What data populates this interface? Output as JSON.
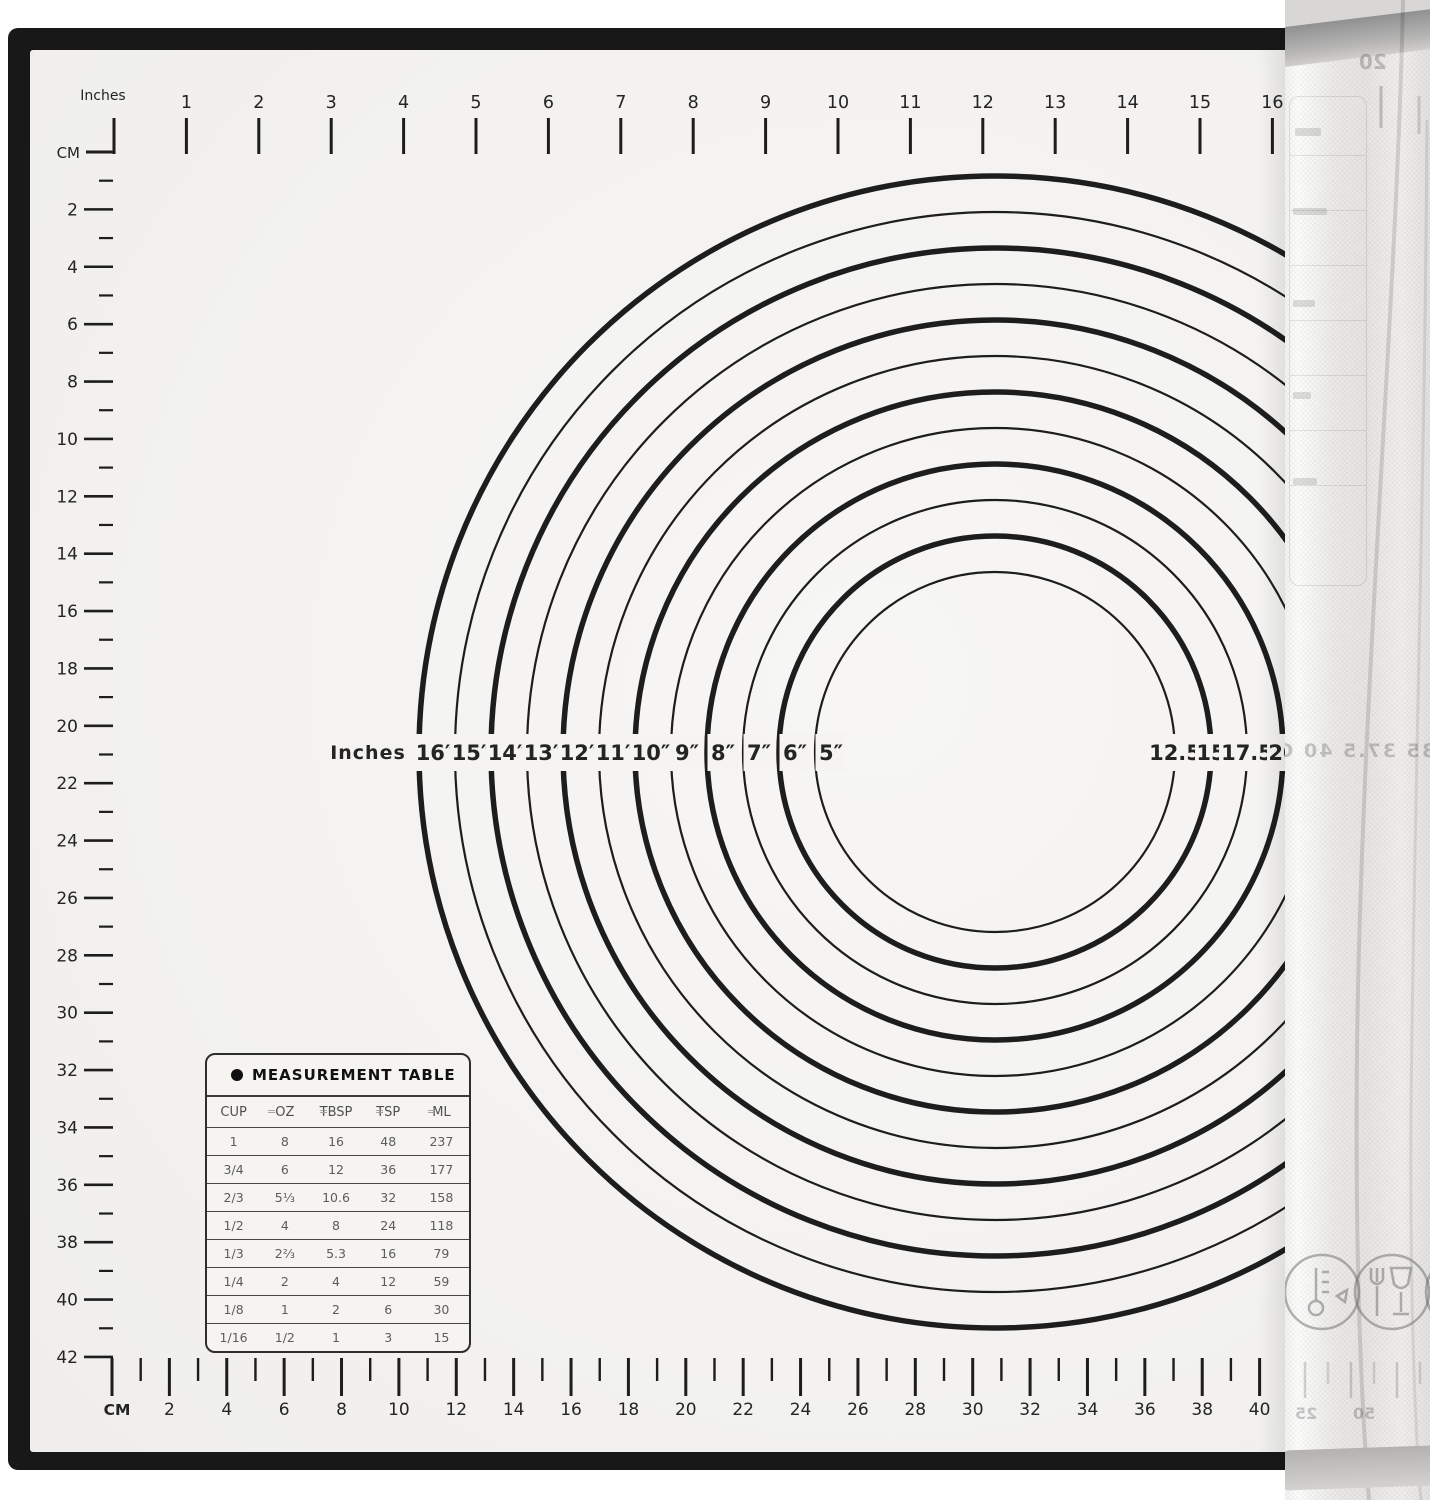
{
  "colors": {
    "frame": "#181818",
    "mat_surface": "#f5f4f1",
    "ink": "#1d1d1d",
    "table_value_text": "#5c5c5c",
    "roll_base": "#ebeae8"
  },
  "top_ruler": {
    "unit_label": "Inches",
    "labels": [
      "1",
      "2",
      "3",
      "4",
      "5",
      "6",
      "7",
      "8",
      "9",
      "10",
      "11",
      "12",
      "13",
      "14",
      "15",
      "16"
    ]
  },
  "left_ruler": {
    "unit_label": "CM",
    "labels": [
      "2",
      "4",
      "6",
      "8",
      "10",
      "12",
      "14",
      "16",
      "18",
      "20",
      "22",
      "24",
      "26",
      "28",
      "30",
      "32",
      "34",
      "36",
      "38",
      "40",
      "42"
    ]
  },
  "bottom_ruler": {
    "unit_label": "CM",
    "labels": [
      "2",
      "4",
      "6",
      "8",
      "10",
      "12",
      "14",
      "16",
      "18",
      "20",
      "22",
      "24",
      "26",
      "28",
      "30",
      "32",
      "34",
      "36",
      "38",
      "40"
    ]
  },
  "circles": {
    "row_unit_label": "Inches",
    "rings": [
      {
        "d": 16,
        "inch_label": "16″"
      },
      {
        "d": 15,
        "inch_label": "15″"
      },
      {
        "d": 14,
        "inch_label": "14″"
      },
      {
        "d": 13,
        "inch_label": "13″"
      },
      {
        "d": 12,
        "inch_label": "12″"
      },
      {
        "d": 11,
        "inch_label": "11″"
      },
      {
        "d": 10,
        "inch_label": "10″"
      },
      {
        "d": 9,
        "inch_label": "9″"
      },
      {
        "d": 8,
        "inch_label": "8″"
      },
      {
        "d": 7,
        "inch_label": "7″"
      },
      {
        "d": 6,
        "inch_label": "6″"
      },
      {
        "d": 5,
        "inch_label": "5″"
      }
    ],
    "cm_labels": [
      {
        "d": 5,
        "label": "12.5"
      },
      {
        "d": 6,
        "label": "15"
      },
      {
        "d": 7,
        "label": "17.5"
      },
      {
        "d": 8,
        "label": "20"
      }
    ]
  },
  "measurement_table": {
    "title": "MEASUREMENT TABLE",
    "columns": [
      "CUP",
      "OZ",
      "TBSP",
      "TSP",
      "ML"
    ],
    "equals_sign": "=",
    "rows": [
      [
        "1",
        "8",
        "16",
        "48",
        "237"
      ],
      [
        "3/4",
        "6",
        "12",
        "36",
        "177"
      ],
      [
        "2/3",
        "5⅓",
        "10.6",
        "32",
        "158"
      ],
      [
        "1/2",
        "4",
        "8",
        "24",
        "118"
      ],
      [
        "1/3",
        "2⅔",
        "5.3",
        "16",
        "79"
      ],
      [
        "1/4",
        "2",
        "4",
        "12",
        "59"
      ],
      [
        "1/8",
        "1",
        "2",
        "6",
        "30"
      ],
      [
        "1/16",
        "1/2",
        "1",
        "3",
        "15"
      ]
    ]
  },
  "roll": {
    "top_mirrored_label": "20",
    "middle_mirrored_labels": "35  37.5  40  CM",
    "bottom_mirrored_labels": [
      "25",
      "50"
    ],
    "icons": [
      "thermometer-icon",
      "food-safe-glass-fork-icon",
      "partial-circle-icon"
    ]
  }
}
